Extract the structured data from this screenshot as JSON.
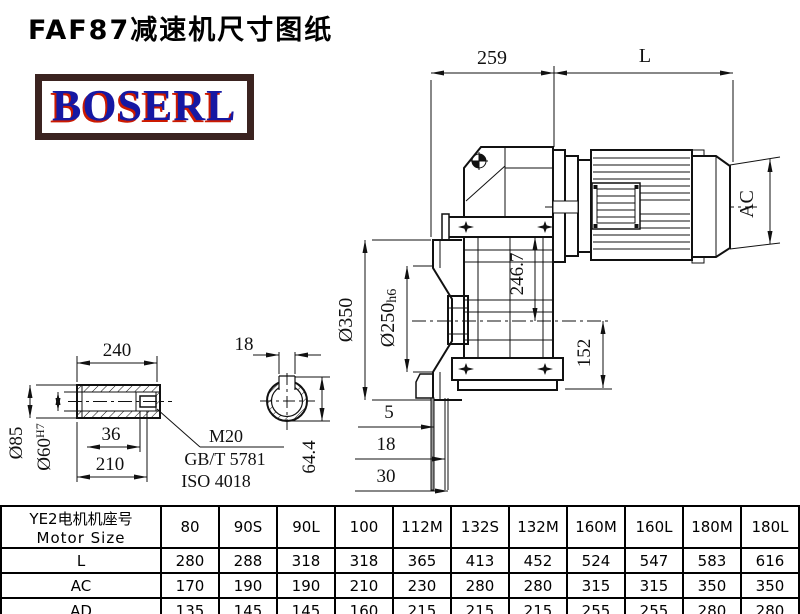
{
  "title": "FAF87减速机尺寸图纸",
  "logo": {
    "text": "BOSERL",
    "border_color": "#3B2320",
    "text_color": "#1618A3",
    "fringe_color": "#CC1A00"
  },
  "drawing": {
    "line_color": "#111111",
    "main": {
      "dim_259": "259",
      "dim_L": "L",
      "dim_AC": "AC",
      "dim_d350": "Ø350",
      "dim_d250": "Ø250",
      "dim_d250_tol": "h6",
      "dim_246_7": "246.7",
      "dim_152": "152",
      "dim_5": "5",
      "dim_18": "18",
      "dim_30": "30"
    },
    "shaft": {
      "dim_240": "240",
      "dim_d85": "Ø85",
      "dim_d60": "Ø60",
      "dim_d60_tol": "H7",
      "dim_36": "36",
      "dim_210": "210",
      "thread_label": "M20",
      "standard_1": "GB/T 5781",
      "standard_2": "ISO 4018"
    },
    "section": {
      "dim_18": "18",
      "dim_64_4": "64.4"
    }
  },
  "table": {
    "header": {
      "line1": "YE2电机机座号",
      "line2": "Motor Size"
    },
    "columns": [
      "80",
      "90S",
      "90L",
      "100",
      "112M",
      "132S",
      "132M",
      "160M",
      "160L",
      "180M",
      "180L"
    ],
    "rows": [
      {
        "label": "L",
        "values": [
          "280",
          "288",
          "318",
          "318",
          "365",
          "413",
          "452",
          "524",
          "547",
          "583",
          "616"
        ]
      },
      {
        "label": "AC",
        "values": [
          "170",
          "190",
          "190",
          "210",
          "230",
          "280",
          "280",
          "315",
          "315",
          "350",
          "350"
        ]
      },
      {
        "label": "AD",
        "values": [
          "135",
          "145",
          "145",
          "160",
          "215",
          "215",
          "215",
          "255",
          "255",
          "280",
          "280"
        ]
      }
    ]
  }
}
